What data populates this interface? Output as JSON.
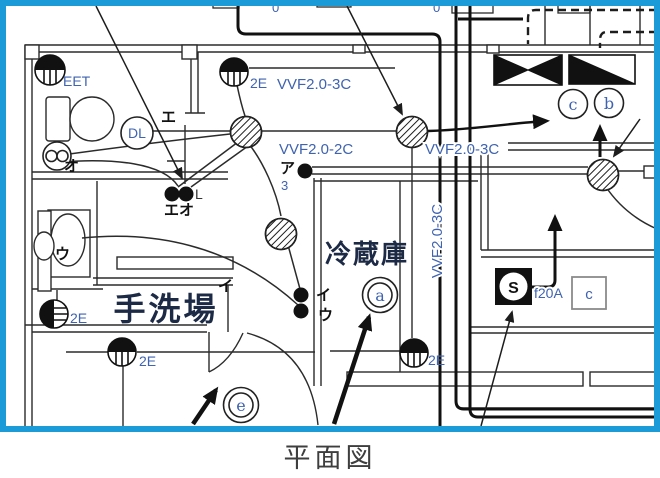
{
  "caption": "平面図",
  "colors": {
    "border": "#1b9bd7",
    "label": "#3f63b0",
    "room": "#1c2a46"
  },
  "cables": {
    "top": "VVF2.0-3C",
    "left": "VVF2.0-2C",
    "right": "VVF2.0-3C",
    "vertical": "VVF2.0-3C"
  },
  "outlets": {
    "eet": "EET",
    "top": "2E",
    "left": "2E",
    "bottom": "2E",
    "right": "2E"
  },
  "rooms": {
    "washstand": "手洗場",
    "fridge": "冷蔵庫"
  },
  "lights": {
    "downlight": "DL"
  },
  "marks": {
    "c": "c",
    "b": "b",
    "a": "a",
    "e": "e",
    "s": "S",
    "fuse": "f20A",
    "c_box": "c",
    "zero_left": "0",
    "zero_right": "0"
  },
  "kana": {
    "e": "エ",
    "o": "オ",
    "eo": "エオ",
    "l": "L",
    "a": "ア",
    "three": "3",
    "i_counter": "イ",
    "i": "イ",
    "u": "ウ",
    "u_fan": "ウ"
  }
}
